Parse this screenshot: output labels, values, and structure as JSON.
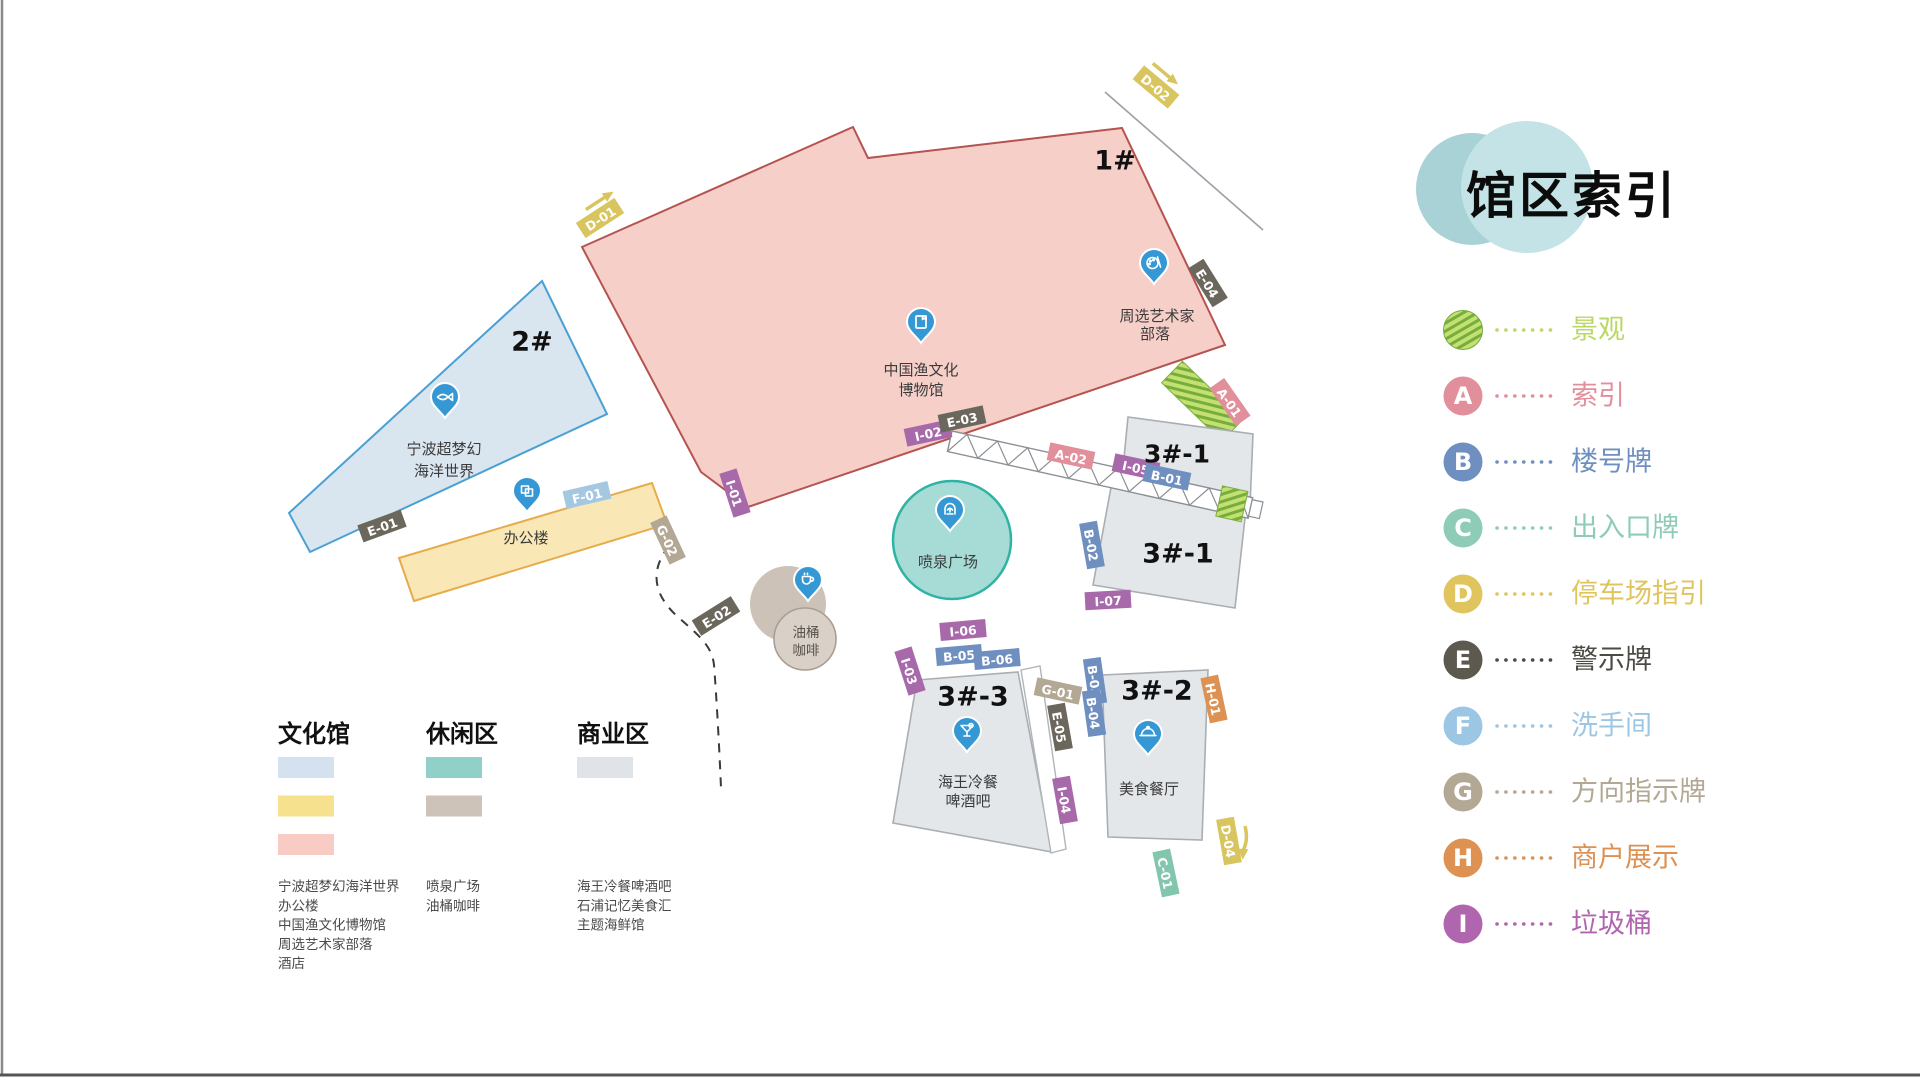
{
  "title": "馆区索引",
  "index_legend": {
    "items": [
      {
        "code": "",
        "label": "景观",
        "color": "#9bc93f",
        "text_color": "#b9d964",
        "hatch": true
      },
      {
        "code": "A",
        "label": "索引",
        "color": "#e28f9c"
      },
      {
        "code": "B",
        "label": "楼号牌",
        "color": "#6e8fbf"
      },
      {
        "code": "C",
        "label": "出入口牌",
        "color": "#8fccb8"
      },
      {
        "code": "D",
        "label": "停车场指引",
        "color": "#e0c55e"
      },
      {
        "code": "E",
        "label": "警示牌",
        "color": "#5d594e",
        "text_color": "#4c4a42"
      },
      {
        "code": "F",
        "label": "洗手间",
        "color": "#9cc7e4"
      },
      {
        "code": "G",
        "label": "方向指示牌",
        "color": "#b3a894"
      },
      {
        "code": "H",
        "label": "商户展示",
        "color": "#dd9254"
      },
      {
        "code": "I",
        "label": "垃圾桶",
        "color": "#b066ae"
      }
    ]
  },
  "zones": {
    "groups": [
      {
        "title": "文化馆",
        "x": 278,
        "swatches": [
          "#d3e2ee",
          "#f5e18e",
          "#f8cbc5"
        ],
        "items": [
          "宁波超梦幻海洋世界",
          "办公楼",
          "中国渔文化博物馆",
          "周选艺术家部落",
          "酒店"
        ]
      },
      {
        "title": "休闲区",
        "x": 426,
        "swatches": [
          "#8fd0c9",
          "#cec3b9"
        ],
        "items": [
          "喷泉广场",
          "油桶咖啡"
        ]
      },
      {
        "title": "商业区",
        "x": 577,
        "swatches": [
          "#e0e4e8"
        ],
        "items": [
          "海王冷餐啤酒吧",
          "石浦记忆美食汇",
          "主题海鲜馆"
        ]
      }
    ]
  },
  "map": {
    "building_labels": {
      "b1": "1#",
      "b2": "2#",
      "b31a": "3#-1",
      "b31b": "3#-1",
      "b33": "3#-3",
      "b32": "3#-2"
    },
    "poi": {
      "museum": [
        "中国渔文化",
        "博物馆"
      ],
      "artist": [
        "周选艺术家",
        "部落"
      ],
      "ocean": [
        "宁波超梦幻",
        "海洋世界"
      ],
      "office": [
        "办公楼"
      ],
      "fountain": [
        "喷泉广场"
      ],
      "coffee": [
        "油桶",
        "咖啡"
      ],
      "bar": [
        "海王冷餐",
        "啤酒吧"
      ],
      "restaurant": [
        "美食餐厅"
      ]
    },
    "tag_colors": {
      "A": "#e28f9c",
      "B": "#6e8fbf",
      "C": "#82c6ae",
      "D": "#d9c55f",
      "E": "#6b675c",
      "F": "#a4c8e1",
      "G": "#b3a894",
      "H": "#dd9254",
      "I": "#a869ab"
    },
    "fill_colors": {
      "culture_pink": "#f6cfc9",
      "culture_blue": "#d9e5ef",
      "culture_yellow": "#f9e8b6",
      "leisure_teal": "#a6dcd5",
      "leisure_taupe": "#cdc2b8",
      "business_gray": "#e3e7ea"
    },
    "tags": [
      {
        "c": "D-02",
        "k": "D",
        "x": 1156,
        "y": 87,
        "r": 40
      },
      {
        "c": "D-01",
        "k": "D",
        "x": 600,
        "y": 218,
        "r": -33
      },
      {
        "c": "E-04",
        "k": "E",
        "x": 1208,
        "y": 283,
        "r": 58
      },
      {
        "c": "A-01",
        "k": "A",
        "x": 1230,
        "y": 402,
        "r": 55
      },
      {
        "c": "I-02",
        "k": "I",
        "x": 928,
        "y": 433,
        "r": -12
      },
      {
        "c": "E-03",
        "k": "E",
        "x": 962,
        "y": 419,
        "r": -12
      },
      {
        "c": "A-02",
        "k": "A",
        "x": 1071,
        "y": 456,
        "r": 12
      },
      {
        "c": "I-05",
        "k": "I",
        "x": 1136,
        "y": 467,
        "r": 12
      },
      {
        "c": "B-01",
        "k": "B",
        "x": 1167,
        "y": 477,
        "r": 12
      },
      {
        "c": "B-02",
        "k": "B",
        "x": 1092,
        "y": 545,
        "r": 80
      },
      {
        "c": "I-07",
        "k": "I",
        "x": 1108,
        "y": 600,
        "r": -3
      },
      {
        "c": "I-01",
        "k": "I",
        "x": 735,
        "y": 493,
        "r": 72
      },
      {
        "c": "F-01",
        "k": "F",
        "x": 587,
        "y": 495,
        "r": -13
      },
      {
        "c": "E-01",
        "k": "E",
        "x": 382,
        "y": 526,
        "r": -20
      },
      {
        "c": "G-02",
        "k": "G",
        "x": 668,
        "y": 540,
        "r": 65
      },
      {
        "c": "E-02",
        "k": "E",
        "x": 716,
        "y": 616,
        "r": -32
      },
      {
        "c": "I-06",
        "k": "I",
        "x": 963,
        "y": 630,
        "r": -5
      },
      {
        "c": "B-05",
        "k": "B",
        "x": 959,
        "y": 655,
        "r": -5
      },
      {
        "c": "B-06",
        "k": "B",
        "x": 997,
        "y": 659,
        "r": -5
      },
      {
        "c": "I-03",
        "k": "I",
        "x": 910,
        "y": 671,
        "r": 72
      },
      {
        "c": "G-01",
        "k": "G",
        "x": 1058,
        "y": 691,
        "r": 12
      },
      {
        "c": "E-05",
        "k": "E",
        "x": 1060,
        "y": 727,
        "r": 80
      },
      {
        "c": "B-03",
        "k": "B",
        "x": 1095,
        "y": 681,
        "r": 82
      },
      {
        "c": "B-04",
        "k": "B",
        "x": 1094,
        "y": 713,
        "r": 82
      },
      {
        "c": "H-01",
        "k": "H",
        "x": 1214,
        "y": 699,
        "r": 78
      },
      {
        "c": "I-04",
        "k": "I",
        "x": 1065,
        "y": 800,
        "r": 80
      },
      {
        "c": "D-04",
        "k": "D",
        "x": 1229,
        "y": 841,
        "r": 80
      },
      {
        "c": "C-01",
        "k": "C",
        "x": 1166,
        "y": 873,
        "r": 78
      }
    ]
  }
}
